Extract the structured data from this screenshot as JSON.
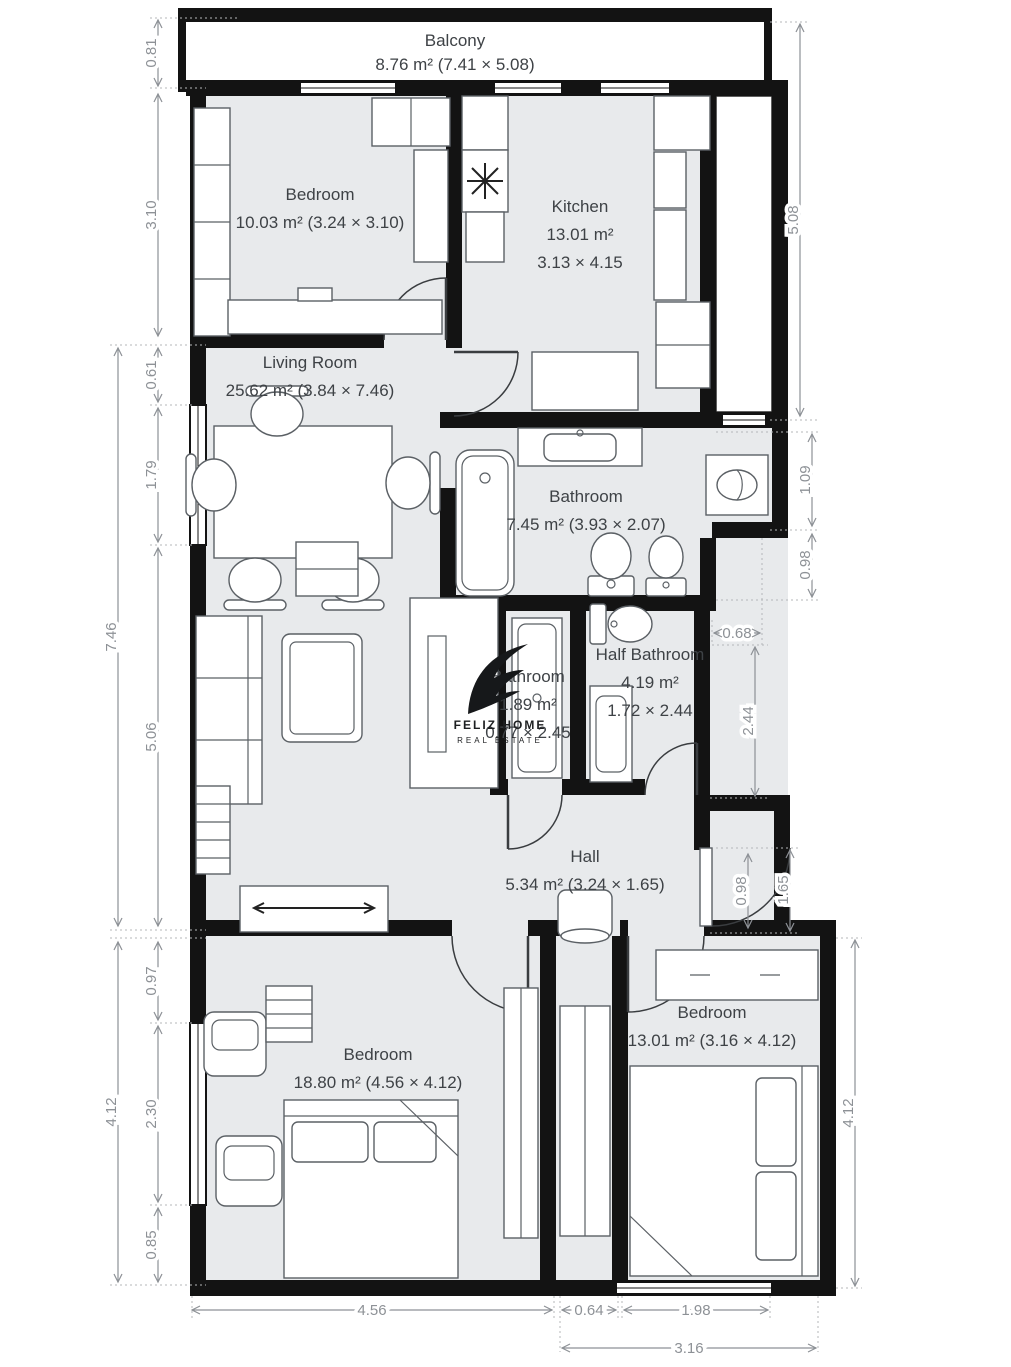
{
  "brand": {
    "name": "FELIZ HOME",
    "tagline": "REAL ESTATE"
  },
  "rooms": [
    {
      "id": "balcony",
      "lines": [
        "Balcony",
        "8.76 m² (7.41 × 5.08)"
      ]
    },
    {
      "id": "bedroom-top-left",
      "lines": [
        "Bedroom",
        "10.03 m² (3.24 × 3.10)"
      ]
    },
    {
      "id": "kitchen",
      "lines": [
        "Kitchen",
        "13.01 m²",
        "3.13 × 4.15"
      ]
    },
    {
      "id": "living-room",
      "lines": [
        "Living Room",
        "25.62 m² (3.84 × 7.46)"
      ]
    },
    {
      "id": "bathroom",
      "lines": [
        "Bathroom",
        "7.45 m² (3.93 × 2.07)"
      ]
    },
    {
      "id": "bathroom-small",
      "lines": [
        "Bathroom",
        "1.89 m²",
        "0.77 × 2.45"
      ]
    },
    {
      "id": "half-bathroom",
      "lines": [
        "Half Bathroom",
        "4.19 m²",
        "1.72 × 2.44"
      ]
    },
    {
      "id": "hall",
      "lines": [
        "Hall",
        "5.34 m² (3.24 × 1.65)"
      ]
    },
    {
      "id": "bedroom-bottom-left",
      "lines": [
        "Bedroom",
        "18.80 m² (4.56 × 4.12)"
      ]
    },
    {
      "id": "bedroom-bottom-right",
      "lines": [
        "Bedroom",
        "13.01 m² (3.16 × 4.12)"
      ]
    }
  ],
  "dimensions": {
    "left_inner": [
      "0.81",
      "3.10",
      "0.61",
      "1.79",
      "5.06",
      "0.97",
      "2.30",
      "0.85"
    ],
    "left_outer": [
      "7.46",
      "4.12"
    ],
    "right": [
      "5.08",
      "1.09",
      "0.98",
      "0.68",
      "2.44",
      "1.65",
      "0.98",
      "4.12"
    ],
    "bottom": [
      "4.56",
      "0.64",
      "1.98",
      "3.16"
    ]
  },
  "colors": {
    "wall": "#131313",
    "floor": "#e8eaec",
    "dimension": "#8d9196",
    "label": "#3e4246"
  }
}
